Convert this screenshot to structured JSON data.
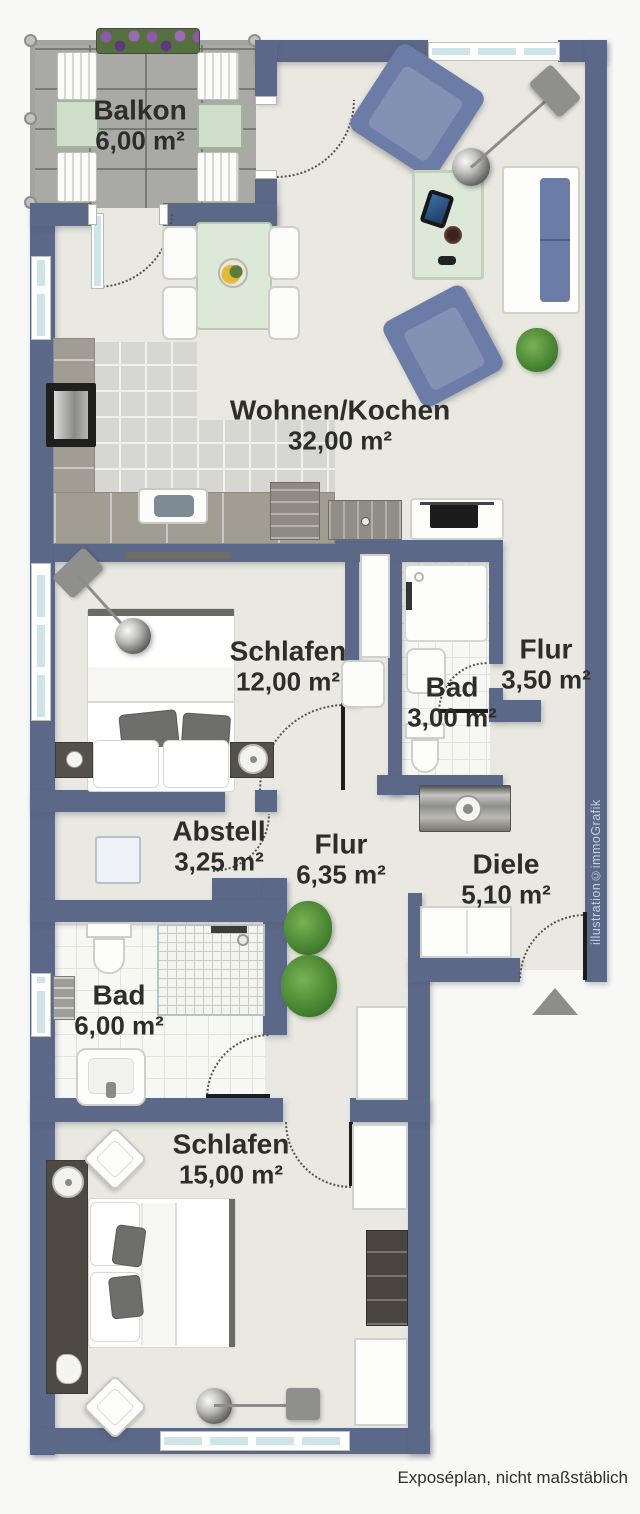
{
  "rooms": [
    {
      "id": "balkon",
      "name": "Balkon",
      "area": "6,00 m²"
    },
    {
      "id": "wohnen",
      "name": "Wohnen/Kochen",
      "area": "32,00 m²"
    },
    {
      "id": "schlafen1",
      "name": "Schlafen",
      "area": "12,00 m²"
    },
    {
      "id": "bad1",
      "name": "Bad",
      "area": "3,00 m²"
    },
    {
      "id": "flur1",
      "name": "Flur",
      "area": "3,50 m²"
    },
    {
      "id": "abstell",
      "name": "Abstell",
      "area": "3,25 m²"
    },
    {
      "id": "flur2",
      "name": "Flur",
      "area": "6,35 m²"
    },
    {
      "id": "diele",
      "name": "Diele",
      "area": "5,10 m²"
    },
    {
      "id": "bad2",
      "name": "Bad",
      "area": "6,00 m²"
    },
    {
      "id": "schlafen2",
      "name": "Schlafen",
      "area": "15,00 m²"
    }
  ],
  "caption": "Exposéplan, nicht maßstäblich",
  "credit": "illustration©immoGrafik",
  "colors": {
    "wall": "#5c6888",
    "floor": "#e9e8e1",
    "outside": "#f8f8f6",
    "glass": "#cfe4e8",
    "furniture_blue": "#6b7ca6",
    "table_green": "#dce8d8",
    "plant_green": "#4e8f3a",
    "text": "#2d2d2b",
    "credit_text": "#c9d0de",
    "arrow": "#8d8d8b"
  }
}
